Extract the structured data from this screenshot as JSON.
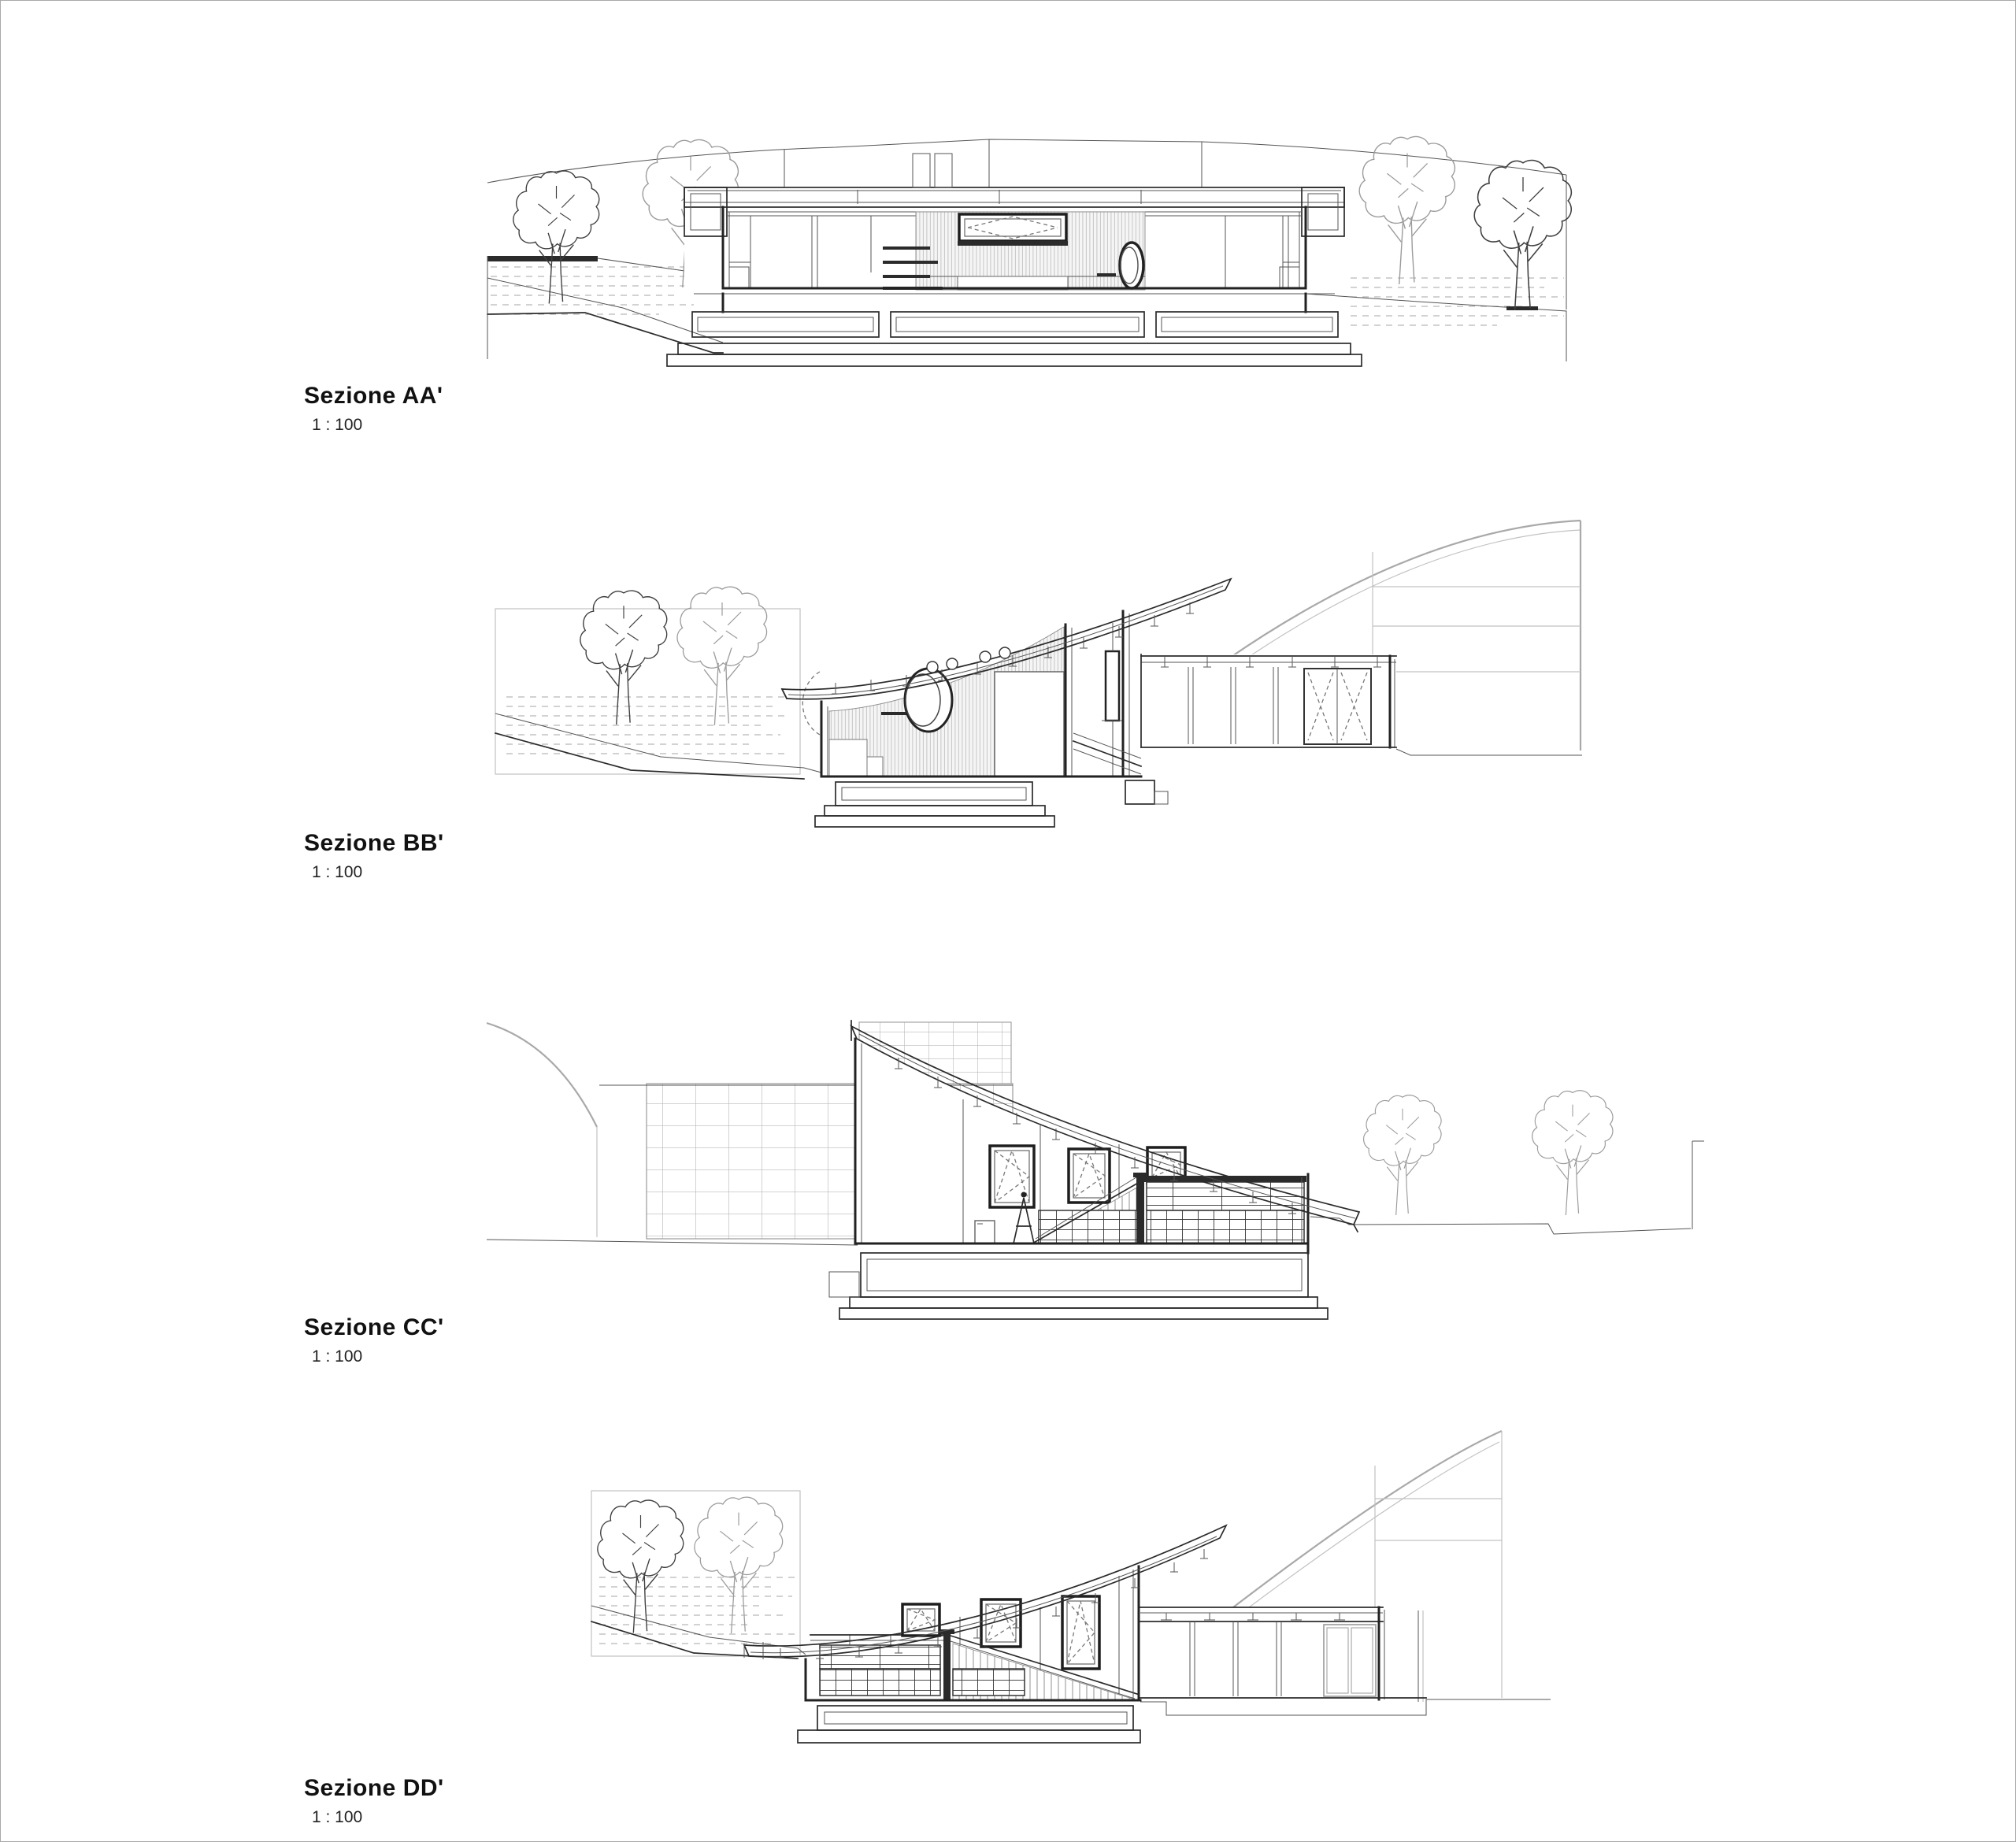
{
  "sheet": {
    "background": "#ffffff",
    "border_color": "#a8a8a8",
    "line_color": "#2b2b2b",
    "light_line_color": "#a9a9a9",
    "hatch_color": "#c6c6c6"
  },
  "sections": [
    {
      "id": "AA",
      "title": "Sezione AA'",
      "scale": "1 : 100"
    },
    {
      "id": "BB",
      "title": "Sezione BB'",
      "scale": "1 : 100"
    },
    {
      "id": "CC",
      "title": "Sezione CC'",
      "scale": "1 : 100"
    },
    {
      "id": "DD",
      "title": "Sezione DD'",
      "scale": "1 : 100"
    }
  ]
}
